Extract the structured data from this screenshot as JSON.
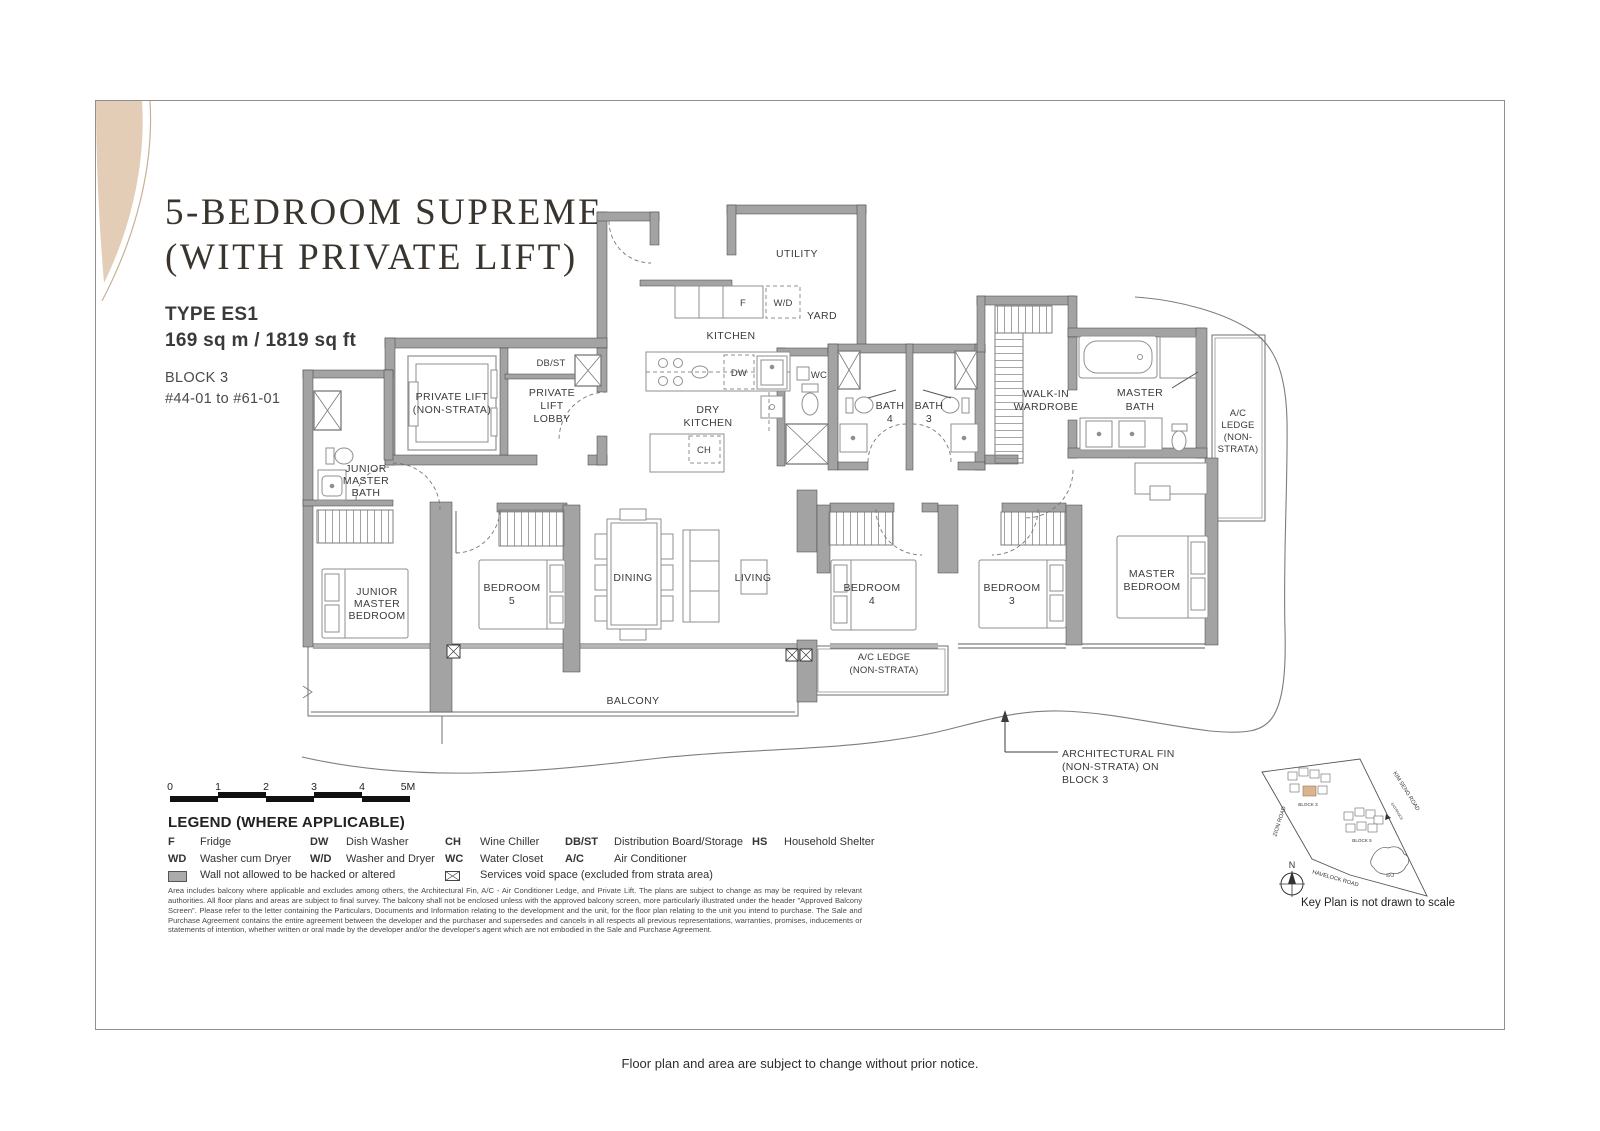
{
  "header": {
    "title_line1": "5-BEDROOM SUPREME",
    "title_line2": "(WITH PRIVATE LIFT)",
    "type_label": "TYPE ES1",
    "area": "169 sq m / 1819 sq ft",
    "block": "BLOCK 3",
    "units": "#44-01 to #61-01"
  },
  "plan": {
    "utility": "UTILITY",
    "yard": "YARD",
    "kitchen": "KITCHEN",
    "dry_kitchen": [
      "DRY",
      "KITCHEN"
    ],
    "f": "F",
    "wd": "W/D",
    "dw": "DW",
    "wc": "WC",
    "ch": "CH",
    "dbst": "DB/ST",
    "private_lift": [
      "PRIVATE LIFT",
      "(NON-STRATA)"
    ],
    "lift_lobby": [
      "PRIVATE",
      "LIFT",
      "LOBBY"
    ],
    "jm_bath": [
      "JUNIOR",
      "MASTER",
      "BATH"
    ],
    "jm_bed": [
      "JUNIOR",
      "MASTER",
      "BEDROOM"
    ],
    "bed5": [
      "BEDROOM",
      "5"
    ],
    "bed4": [
      "BEDROOM",
      "4"
    ],
    "bed3": [
      "BEDROOM",
      "3"
    ],
    "dining": "DINING",
    "living": "LIVING",
    "master_bed": [
      "MASTER",
      "BEDROOM"
    ],
    "bath4": [
      "BATH",
      "4"
    ],
    "bath3": [
      "BATH",
      "3"
    ],
    "wiw": [
      "WALK-IN",
      "WARDROBE"
    ],
    "master_bath": [
      "MASTER",
      "BATH"
    ],
    "ac_right": [
      "A/C",
      "LEDGE",
      "(NON-",
      "STRATA)"
    ],
    "ac_bottom": [
      "A/C LEDGE",
      "(NON-STRATA)"
    ],
    "balcony": "BALCONY",
    "fin": [
      "ARCHITECTURAL FIN",
      "(NON-STRATA) ON",
      "BLOCK 3"
    ]
  },
  "scalebar": {
    "labels": [
      "0",
      "1",
      "2",
      "3",
      "4",
      "5M"
    ]
  },
  "legend": {
    "title": "LEGEND (WHERE APPLICABLE)",
    "row1": [
      {
        "abbr": "F",
        "desc": "Fridge"
      },
      {
        "abbr": "DW",
        "desc": "Dish Washer"
      },
      {
        "abbr": "CH",
        "desc": "Wine Chiller"
      },
      {
        "abbr": "DB/ST",
        "desc": "Distribution Board/Storage"
      },
      {
        "abbr": "HS",
        "desc": "Household Shelter"
      }
    ],
    "row2": [
      {
        "abbr": "WD",
        "desc": "Washer cum Dryer"
      },
      {
        "abbr": "W/D",
        "desc": "Washer and Dryer"
      },
      {
        "abbr": "WC",
        "desc": "Water Closet"
      },
      {
        "abbr": "A/C",
        "desc": "Air Conditioner"
      }
    ],
    "wall_note": "Wall not allowed to be hacked or altered",
    "services_note": "Services void space (excluded from strata area)"
  },
  "disclaimer": "Area includes balcony where applicable and excludes among others, the Architectural Fin, A/C - Air Conditioner Ledge, and Private Lift. The plans are subject to change as may be required by relevant authorities. All floor plans and areas are subject to final survey. The balcony shall not be enclosed unless with the approved balcony screen, more particularly illustrated under the header \"Approved Balcony Screen\". Please refer to the letter containing the Particulars, Documents and Information relating to the development and the unit, for the floor plan relating to the unit you intend to purchase. The Sale and Purchase Agreement contains the entire agreement between the developer and the purchaser and supersedes and cancels in all respects all previous representations, warranties, promises, inducements or statements of intention, whether written or oral made by the developer and/or the developer's agent which are not embodied in the Sale and Purchase Agreement.",
  "keyplan": {
    "roads": {
      "zion": "ZION ROAD",
      "kim_seng": "KIM SENG ROAD",
      "havelock": "HAVELOCK ROAD"
    },
    "entrance": "ENTRANCE",
    "block3": "BLOCK 3",
    "block5": "BLOCK 5",
    "saj": "SAJ",
    "north": "N",
    "note": "Key Plan is not drawn to scale"
  },
  "footer": "Floor plan and area are subject to change without prior notice.",
  "colors": {
    "accent_tan": "#e3cdb6",
    "wall_gray": "#a3a3a3",
    "highlight_unit": "#d9b48e"
  }
}
